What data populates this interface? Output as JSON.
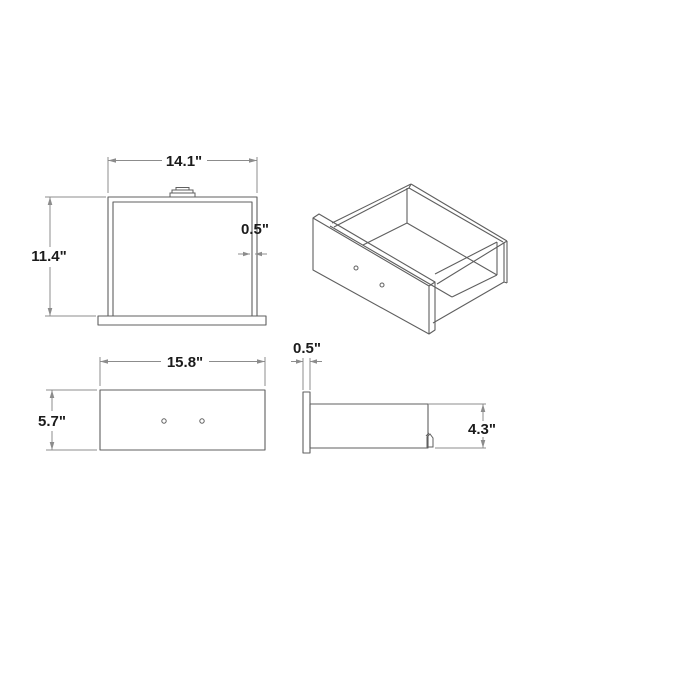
{
  "theme": {
    "background": "#ffffff",
    "part_line": "#5f5f5f",
    "dim_line": "#8c8c8c",
    "text_color": "#1b1b1b"
  },
  "drawing": {
    "subject": "drawer",
    "views": {
      "top": {
        "width_label": "14.1\"",
        "depth_label": "11.4\"",
        "side_thickness_label": "0.5\""
      },
      "front": {
        "width_label": "15.8\"",
        "height_label": "5.7\""
      },
      "side": {
        "front_thickness_label": "0.5\"",
        "side_height_label": "4.3\""
      }
    }
  }
}
